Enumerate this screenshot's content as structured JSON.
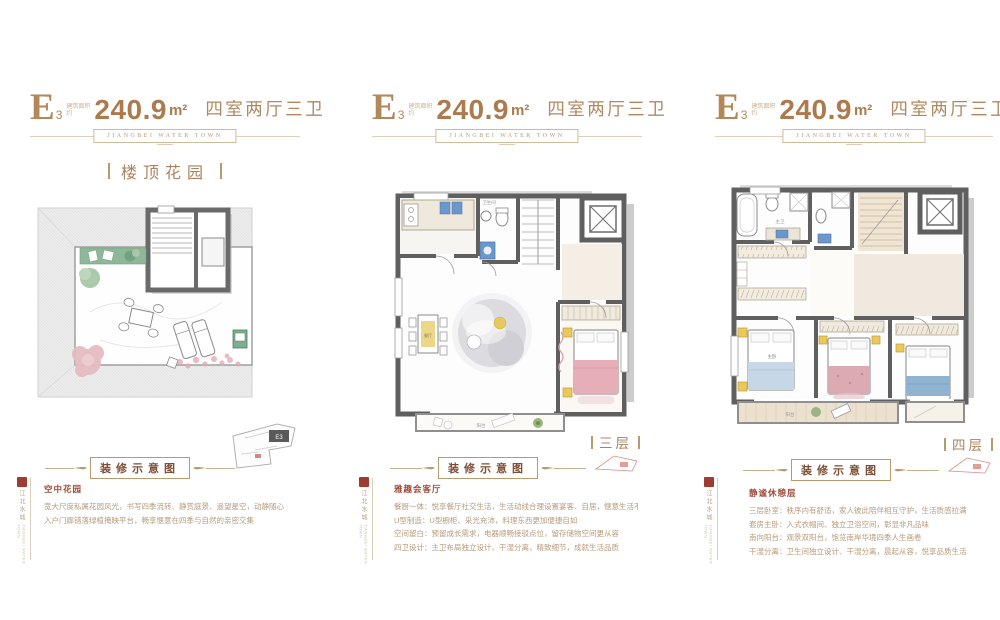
{
  "brand": {
    "banner_text": "JIANGBEI WATER TOWN"
  },
  "shared": {
    "area_label_top": "建筑面积",
    "area_label_bottom": "约",
    "decor_label": "装修示意图",
    "seal_cn": "江北水城",
    "seal_en": "JIANGBEI WATER TOWN"
  },
  "panels": [
    {
      "unit": "E",
      "unit_sub": "3",
      "area_value": "240.9",
      "area_unit": "m²",
      "rooms": "四室两厅三卫",
      "top_tag": "楼顶花园",
      "keyplan_label": "E3",
      "desc_title": "空中花园",
      "desc_lines": [
        "宽大尺度私属花园风光，书写四季流转、静赏庭景、遥望星空，动静随心",
        "入户门廊错落绿植掩映平台，畅享惬意在四季与自然的亲密交集"
      ]
    },
    {
      "unit": "E",
      "unit_sub": "3",
      "area_value": "240.9",
      "area_unit": "m²",
      "rooms": "四室两厅三卫",
      "side_tag": "三层",
      "room_labels": {
        "bath": "卫生间",
        "dining": "餐厅",
        "balcony": "阳台"
      },
      "desc_title": "雅趣会客厅",
      "desc_lines": [
        "餐厨一体：悦享餐厅社交生活，生活动线合理设置宴客、自居，惬意生活不打扰",
        "U型制造：U型橱柜、采光充沛，料理东西更加便捷自如",
        "空间留白：预留成长需求，电器顺畅接驳点位，留存储物空间更从容",
        "四卫设计：主卫布局独立设计、干湿分离，精致细节，成就生活品质"
      ]
    },
    {
      "unit": "E",
      "unit_sub": "3",
      "area_value": "240.9",
      "area_unit": "m²",
      "rooms": "四室两厅三卫",
      "side_tag": "四层",
      "room_labels": {
        "bath": "主卫",
        "master": "主卧",
        "balcony": "阳台"
      },
      "desc_title": "静谧休憩层",
      "desc_lines": [
        "三层卧室：秩序内有舒适，家人彼此陪伴相互守护，生活质感拉满",
        "套房主卧：入式衣帽间、独立卫浴空间，彰显非凡品味",
        "南向阳台：观景双阳台，饱览南岸华境四季人生画卷",
        "干湿分离：卫生间独立设计、干湿分离，晨起从容，悦享品质生活"
      ]
    }
  ]
}
